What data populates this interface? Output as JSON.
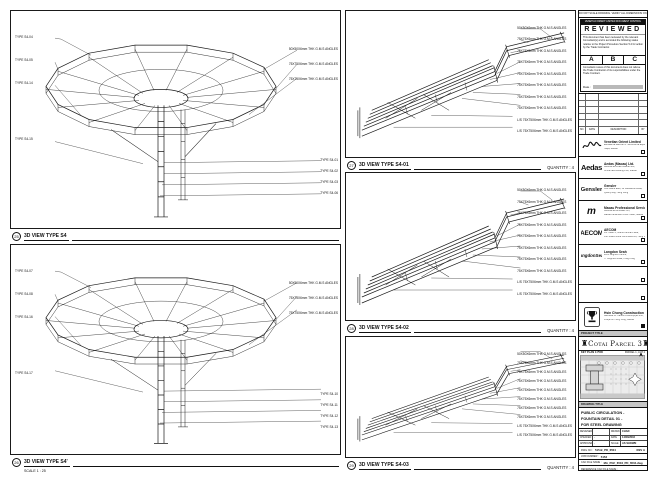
{
  "sheet": {
    "disclaimer": "DO NOT SCALE DRAWING. VERIFY ALL DIMENSIONS ON SITE PRIOR TO CONSTRUCTION.",
    "scale_note": "SCALE 1 : 25"
  },
  "panels": {
    "left_top": {
      "detail_no": "25",
      "title": "3D VIEW TYPE S4",
      "labels_left": [
        "TYPE S4-04",
        "TYPE S4-05",
        "TYPE S4-14",
        "TYPE S4-15"
      ],
      "labels_right_members": [
        "50X50X6mm THK G.M.S ANGLES",
        "75X75X6mm THK G.M.S ANGLES",
        "75X75X6mm THK G.M.S ANGLES"
      ],
      "labels_right_types": [
        "TYPE S4-01",
        "TYPE S4-02",
        "TYPE S4-03",
        "TYPE S4-06"
      ]
    },
    "left_bottom": {
      "detail_no": "26",
      "title": "3D VIEW TYPE S4'",
      "scale": "SCALE 1 : 25",
      "labels_left": [
        "TYPE S4-07",
        "TYPE S4-08",
        "TYPE S4-16",
        "TYPE S4-17"
      ],
      "labels_right_members": [
        "50X50X6mm THK G.M.S ANGLES",
        "75X75X6mm THK G.M.S ANGLES",
        "75X75X6mm THK G.M.S ANGLES"
      ],
      "labels_right_types": [
        "TYPE S4-10",
        "TYPE S4-11",
        "TYPE S4-12",
        "TYPE S4-13"
      ]
    },
    "mid_top": {
      "detail_no": "27",
      "title": "3D VIEW TYPE S4-01",
      "quantity": "QUANTITY : 4",
      "labels": [
        "50X50X6mm THK G.M.S ANGLES",
        "75X75X6mm THK G.M.S ANGLES",
        "75X75X6mm THK G.M.S ANGLES",
        "75X75X6mm THK G.M.S ANGLES",
        "75X75X6mm THK G.M.S ANGLES",
        "75X75X6mm THK G.M.S ANGLES",
        "75X75X6mm THK G.M.S ANGLES",
        "75X75X6mm THK G.M.S ANGLES",
        "L/S 75X75X6mm THK G.M.S ANGLES",
        "L/S 75X75X6mm THK G.M.S ANGLES"
      ]
    },
    "mid_mid": {
      "detail_no": "28",
      "title": "3D VIEW TYPE S4-02",
      "quantity": "QUANTITY : 4",
      "labels": [
        "50X50X6mm THK G.M.S ANGLES",
        "75X75X6mm THK G.M.S ANGLES",
        "75X75X6mm THK G.M.S ANGLES",
        "75X75X6mm THK G.M.S ANGLES",
        "75X75X6mm THK G.M.S ANGLES",
        "75X75X6mm THK G.M.S ANGLES",
        "75X75X6mm THK G.M.S ANGLES",
        "75X75X6mm THK G.M.S ANGLES",
        "L/S 75X75X6mm THK G.M.S ANGLES",
        "L/S 75X75X6mm THK G.M.S ANGLES"
      ]
    },
    "mid_bottom": {
      "detail_no": "29",
      "title": "3D VIEW TYPE S4-03",
      "quantity": "QUANTITY : 4",
      "labels": [
        "50X50X6mm THK G.M.S ANGLES",
        "75X75X6mm THK G.M.S ANGLES",
        "75X75X6mm THK G.M.S ANGLES",
        "75X75X6mm THK G.M.S ANGLES",
        "75X75X6mm THK G.M.S ANGLES",
        "75X75X6mm THK G.M.S ANGLES",
        "75X75X6mm THK G.M.S ANGLES",
        "75X75X6mm THK G.M.S ANGLES",
        "L/S 75X75X6mm THK G.M.S ANGLES",
        "L/S 75X75X6mm THK G.M.S ANGLES"
      ]
    }
  },
  "review": {
    "bar": "VENETIAN ORIENT LIMITED DOCUMENT CONTROL",
    "title": "REVIEWED",
    "para1": "This document has been reviewed by the relevant Consultant(s) and is accorded the following status relative to the Project Procedure Section 5.4 for action by the Trade Contractor.",
    "statuses": [
      "A",
      "B",
      "C"
    ],
    "para2": "Consultant review of this document does not relieve the Trade Contractor of its responsibilities under the Trade Contract.",
    "date_label": "Date :"
  },
  "revision_table": {
    "headers": [
      "NO.",
      "DATE",
      "DESCRIPTION",
      "BY"
    ]
  },
  "companies": [
    {
      "logo": "signature",
      "name": "Venetian Orient Limited",
      "lines": [
        "Estrada da Baía de N. Senhora da Esperança,",
        "Taipa, Macau"
      ]
    },
    {
      "logo": "Aedas",
      "name": "Aedas (Macau) Ltd.",
      "lines": [
        "Avenida da Praia Grande 409,",
        "China Law Building 21/F, Macau"
      ]
    },
    {
      "logo": "Gensler",
      "name": "Gensler",
      "lines": [
        "One Island East, 18 Westlands Road,",
        "Quarry Bay, Hong Kong"
      ]
    },
    {
      "logo": "m",
      "name": "Macau Professional Services Ltd.",
      "lines": [
        "Avenida da Amizade 555,",
        "Macau Landmark Office Tower, Macau"
      ]
    },
    {
      "logo": "AECOM",
      "name": "AECOM",
      "lines": [
        "8/F Tower 2, Grand Central Plaza,",
        "138 Shatin Rural Committee Rd, Hong Kong"
      ]
    },
    {
      "logo": "LangdonSeah",
      "name": "Langdon Seah",
      "lines": [
        "2101 Leighton Centre,",
        "77 Leighton Road, Hong Kong"
      ]
    }
  ],
  "contractor": {
    "name": "Hsin Chong Construction (Macau) Co. Ltd.",
    "lines": [
      "Alameda Dr. Carlos d'Assumpção 258,",
      "Praça Kin Heng Long, Macau"
    ]
  },
  "title_block": {
    "project_title_label": "PROJECT TITLE",
    "project_title": "Cotai Parcel 3",
    "key_plan_label": "KEY PLAN",
    "key_plan_scale": "1:7500",
    "key_plan_parcel": "PARCEL 1, LOT 2",
    "drawing_title_label": "DRAWING TITLE",
    "drawing_title_lines": [
      "PUBLIC CIRCULATION -",
      "FOUNTAIN DETAIL 01 -",
      "FOR STEEL DRAWING"
    ],
    "designed_label": "DESIGNED",
    "designed_value": "",
    "drawn_label": "DRAWN",
    "drawn_value": "CHAD",
    "checked_label": "CHECKED",
    "checked_value": "-",
    "date_label": "DATE",
    "date_value": "14/03/2016",
    "approved_label": "APPROVED",
    "approved_value": "-",
    "scale_label": "SCALE",
    "scale_value": "AS SHOWN",
    "dwg_no_label": "DWG NO :",
    "dwg_no_value": "515-B_PD_6504",
    "rev": "REV A",
    "job_label": "JOB NUMBER :",
    "job_value": "5153",
    "cad_label": "CAD FILE NAME :",
    "cad_value": "MA_PGF_6504_PD_6504.dwg",
    "ref_label": "REFERENCE CAD FILE NAME :",
    "ref_value": ""
  },
  "colors": {
    "line": "#1a1a1a",
    "grey_bar": "#c6c6c6",
    "date_strip": "#b9b9b9",
    "stamp_bar": "#111111"
  }
}
